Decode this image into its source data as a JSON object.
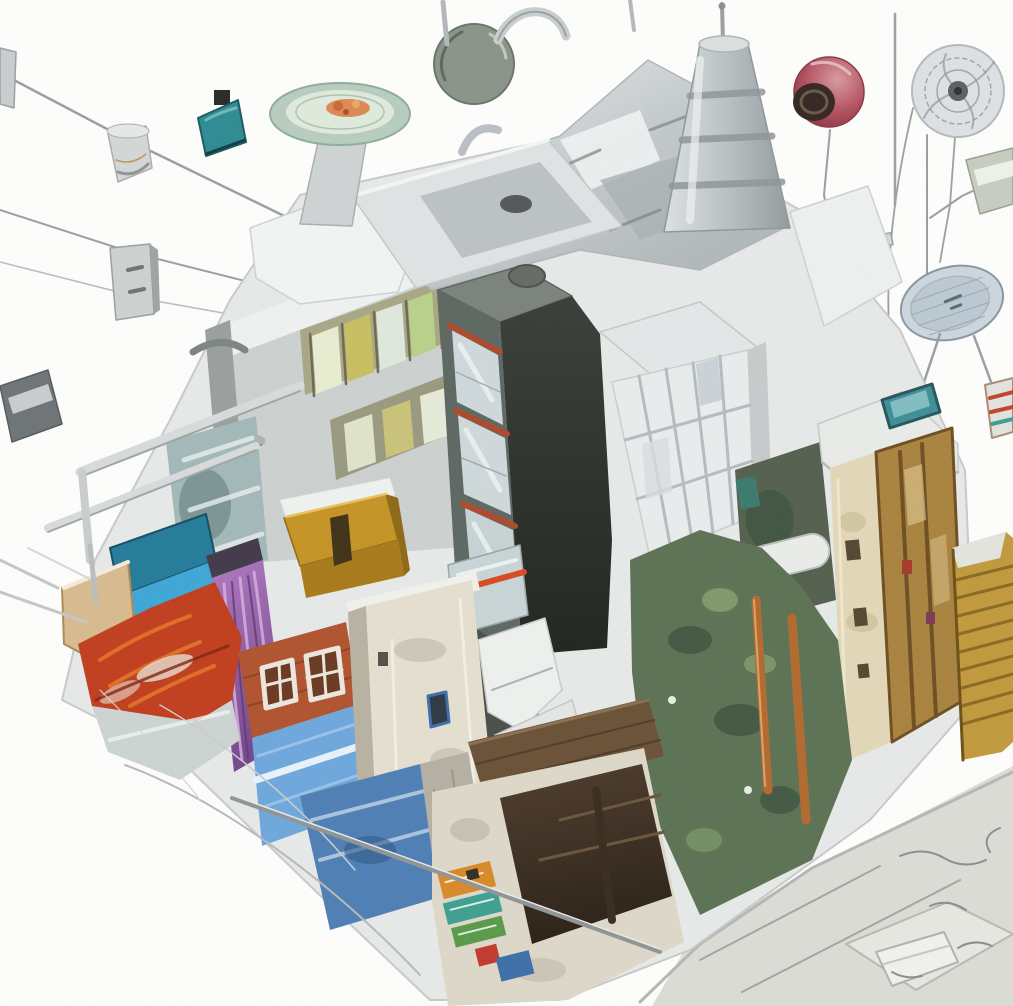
{
  "image": {
    "title": "Surreal isometric city-block collage",
    "description": "Watercolor-style illustration of a surreal isometric city block assembled from mismatched buildings and chrome kitchen machinery. Thin wires radiate outward to floating objects: a gray lamp, a teal lampshade, a hanging sign, a red eye-like sphere, a sketched fan and a satellite dish. A pale green plate of food sits on a pedestal on the roof. Colorful facades include a blue glass house, a purple drape, a mustard box, a red roof, a brick house over a sky-blue wall, a dark window tower with rust stripes, a white grid-window tower, tan and gold towers, a mossy green overgrown wall and a poster-covered kiosk, all on a white sketchbook background."
  },
  "palette": {
    "paper": "#fdfdfc",
    "sketch_line": "#9aa0a2",
    "underlay": "#e7e9e8",
    "metal_light": "#e3e7e8",
    "metal_mid": "#c3c9cb",
    "metal_dark": "#8d9497",
    "plate_rim": "#b7cdbf",
    "plate_inner": "#dfe9dc",
    "plate_food": "#dc8a55",
    "lamp_gray": "#d3d7d6",
    "lamp_teal": "#2f8b93",
    "sphere_red": "#b2505e",
    "sphere_iris": "#352824",
    "fan_body": "#dde1e3",
    "dish_body": "#cdd6dd",
    "bldg_gray": "#ccd1cf",
    "window_olive": "#a8a887",
    "glass_blue": "#cfd9db",
    "roof_teal": "#257c99",
    "wall_blue": "#3fa7d6",
    "wall_cyan": "#8fd0ea",
    "drape_purple": "#9d67b2",
    "box_mustard": "#c59426",
    "roof_red": "#c13f1f",
    "gable_tan": "#d8bb8f",
    "house_brick": "#b05430",
    "wall_sky": "#6fa8dc",
    "bldg_cream": "#e4dfcf",
    "wall_paint_blue": "#4f7fb5",
    "tower_dark": "#5e6862",
    "stripe_rust": "#ad4a2c",
    "tower_white": "#e9ecec",
    "moss_green": "#5d7355",
    "pipe_rust": "#b26a2e",
    "tower_tan": "#e2d8b8",
    "facade_gold": "#a9833f",
    "tower_gold": "#c19a3e",
    "sign_teal": "#3f8f96",
    "kiosk_cream": "#ddd8c8",
    "poster_orange": "#d98a28",
    "poster_teal": "#3fa08f",
    "poster_green": "#5a9a4a",
    "poster_red": "#c23b2e",
    "poster_blue": "#3f6fa8",
    "ground_gray": "#dcdcd6",
    "box_white": "#f0f1ec"
  },
  "scene": {
    "floating_objects": [
      {
        "name": "wall-bracket",
        "side": "top-left"
      },
      {
        "name": "gray-cone-lamp",
        "side": "upper-left"
      },
      {
        "name": "teal-lampshade",
        "side": "upper-left"
      },
      {
        "name": "hanging-sign-panel",
        "side": "left"
      },
      {
        "name": "dark-floating-bar",
        "side": "left"
      },
      {
        "name": "red-eye-sphere",
        "side": "top-right"
      },
      {
        "name": "sketched-fan",
        "side": "top-right"
      },
      {
        "name": "satellite-dish",
        "side": "right"
      },
      {
        "name": "floating-panel",
        "side": "right-edge"
      }
    ],
    "rooftop": [
      {
        "name": "plate-of-food-on-pedestal"
      },
      {
        "name": "chrome-machinery-mass"
      },
      {
        "name": "dark-olive-pan-lid"
      },
      {
        "name": "faucet-arc"
      },
      {
        "name": "banded-funnel-tower"
      },
      {
        "name": "metal-sink-counter"
      },
      {
        "name": "antenna-poles"
      }
    ],
    "buildings": [
      {
        "name": "gray-slab-with-olive-window-band"
      },
      {
        "name": "blue-glass-house"
      },
      {
        "name": "purple-drape-building"
      },
      {
        "name": "mustard-box-building"
      },
      {
        "name": "red-roof-house-with-tan-gable"
      },
      {
        "name": "brick-house-over-sky-blue-wall"
      },
      {
        "name": "cream-building"
      },
      {
        "name": "dark-window-tower-with-rust-stripes"
      },
      {
        "name": "white-grid-window-tower"
      },
      {
        "name": "mossy-grunge-wall-with-capsule"
      },
      {
        "name": "tan-tower-with-teal-sign"
      },
      {
        "name": "gold-ornate-facade"
      },
      {
        "name": "gold-slatted-tower"
      },
      {
        "name": "overgrown-moss-wall-with-rust-pipes"
      },
      {
        "name": "green-striped-awning"
      },
      {
        "name": "poster-kiosk"
      }
    ],
    "ground": [
      {
        "name": "white-paper-ground-left"
      },
      {
        "name": "gray-ground-plane-right"
      },
      {
        "name": "pencil-arc-strokes"
      },
      {
        "name": "leaning-pole"
      },
      {
        "name": "small-white-box"
      },
      {
        "name": "scribble-marks"
      }
    ]
  }
}
